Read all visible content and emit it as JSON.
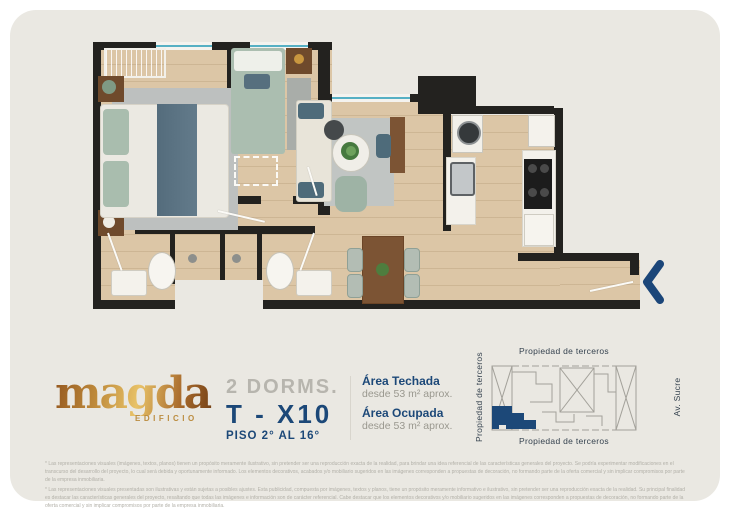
{
  "brand": {
    "logo_text": "magda",
    "logo_subtitle": "EDIFICIO"
  },
  "unit": {
    "bedrooms_label": "2 DORMS.",
    "code": "T - X10",
    "floors_label": "PISO 2° AL 16°"
  },
  "areas": {
    "techada_label": "Área Techada",
    "techada_value": "desde 53 m² aprox.",
    "ocupada_label": "Área Ocupada",
    "ocupada_value": "desde 53 m² aprox."
  },
  "minimap": {
    "label_top": "Propiedad de terceros",
    "label_bottom": "Propiedad de terceros",
    "label_left": "Propiedad de terceros",
    "label_right": "Av. Sucre"
  },
  "icons": {
    "entry_arrow": "chevron-left"
  },
  "colors": {
    "brand_navy": "#1c4878",
    "gold": "#c08c3c",
    "wall": "#23221f",
    "wood_floor": "#dcc6a6",
    "window_cyan": "#56b0c4",
    "card_background": "#eae8e2"
  },
  "disclaimer": {
    "p1": "* Las representaciones visuales (imágenes, textos, planos) tienen un propósito meramente ilustrativo, sin pretender ser una reproducción exacta de la realidad, para brindar una idea referencial de las características generales del proyecto. Se podría experimentar modificaciones en el transcurso del desarrollo del proyecto, lo cual será debida y oportunamente informado. Los elementos decorativos, acabados y/o mobiliario sugeridos en las imágenes corresponden a propuestas de decoración, no formando parte de la oferta comercial y sin implicar compromisos por parte de la empresa inmobiliaria.",
    "p2": "* Las representaciones visuales presentadas son ilustrativas y están sujetas a posibles ajustes. Esta publicidad, compuesta por imágenes, textos y planos, tiene un propósito meramente informativo e ilustrativo, sin pretender ser una reproducción exacta de la realidad. Su principal finalidad es destacar las características generales del proyecto, resaltando que todas las imágenes e información son de carácter referencial. Cabe destacar que los elementos decorativos y/o mobiliario sugeridos en las imágenes corresponden a propuestas de decoración, no formando parte de la oferta comercial y sin implicar compromisos por parte de la empresa inmobiliaria."
  }
}
